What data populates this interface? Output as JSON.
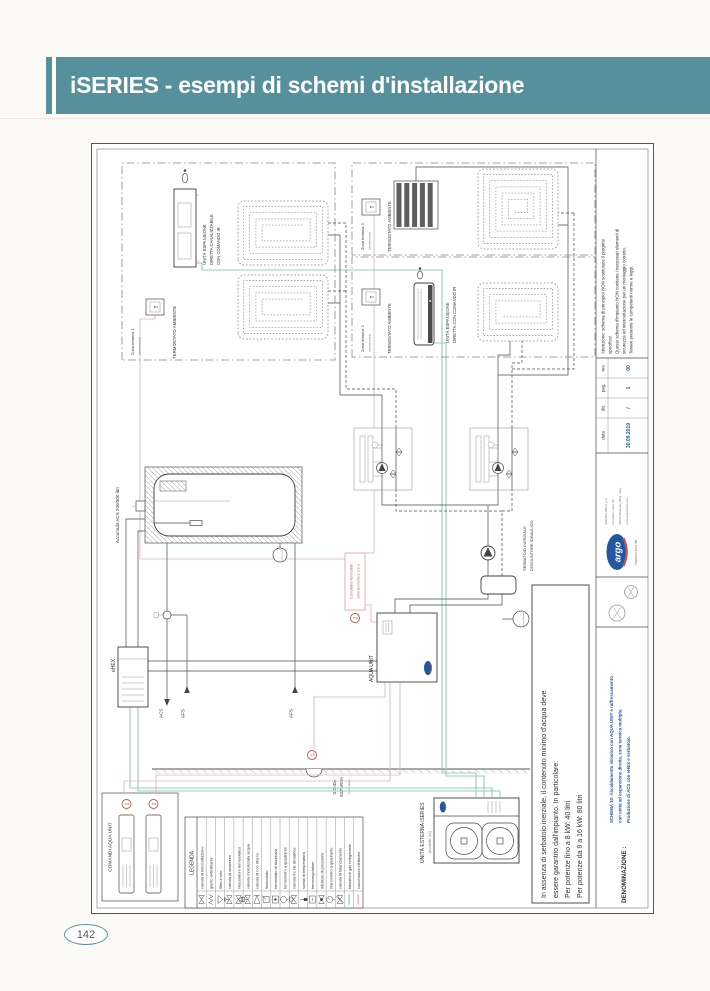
{
  "page": {
    "title": "iSERIES - esempi di schemi d'installazione",
    "number": "142"
  },
  "colors": {
    "header_teal": "#57909d",
    "accent_red": "#c4554e",
    "accent_blue": "#2456a4",
    "refrigerant_green": "#97cdb4",
    "electrical_pink": "#dfb3bb"
  },
  "diagram": {
    "zones": {
      "zone1": {
        "name": "Zona termica 1",
        "sub": "(temperatura)",
        "t": "T",
        "thermostat_label": "TERMOSTATO AMBIENTE",
        "unit_lines": [
          "UNITÀ ESPANSIONE",
          "DIRETTA CANALIZZABILE",
          "CON COMANDO IR"
        ]
      },
      "zone2": {
        "name": "Zona termica 2",
        "sub": "(temperatura)",
        "t": "T",
        "thermostat_label": "TERMOSTATO AMBIENTE",
        "unit_lines": [
          "UNITÀ ESPANSIONE",
          "DIRETTA CON COMANDO IR"
        ]
      },
      "zone3": {
        "name": "Zona termica 3",
        "sub": "(temperatura)",
        "t": "T",
        "thermostat_label": "TERMOSTATO AMBIENTE"
      }
    },
    "labels": {
      "tank": "Accumulo ACS 200/300 litri",
      "ehex": "eHEX",
      "acs": "ACS",
      "afs_top": "AFS",
      "afs_bottom": "AFS",
      "aqua_unit": "AQUA UNIT",
      "separator_lines": [
        "SERBATOIO INERZIALE",
        "DISGIUNTORE IDRAULICO"
      ],
      "sonda_lines": [
        "SONDA",
        "ESTERNA",
        "(opzionale)"
      ],
      "outdoor_unit": "UNITÀ ESTERNA iSERIES",
      "outdoor_model": "(modello XX)",
      "comandi": "COMANDI AQUA UNIT",
      "cumulativo_lines": [
        "Cumulativo termostati",
        "zone termiche 1 2 e 3"
      ],
      "marker1": "1",
      "marker2": "2"
    },
    "note_lines": [
      "In assenza di serbatoio inerziale, il contenuto minimo d'acqua deve",
      "essere garantito dall'impianto. In particolare:",
      "Per potenze fino a 8 kW: 40 litri",
      "Per potenze da 9 a 16 kW: 80 litri"
    ],
    "legend": {
      "title": "LEGENDA",
      "items": [
        {
          "label": "valvola di intercettazione",
          "symbol": "gate-valve"
        },
        {
          "label": "giunto antivibrante",
          "symbol": "flex-joint"
        },
        {
          "label": "filtro a rete",
          "symbol": "strainer"
        },
        {
          "label": "valvola di sicurezza",
          "symbol": "safety-valve"
        },
        {
          "label": "miscelatore termostatico",
          "symbol": "mixing-valve"
        },
        {
          "label": "valvola motorizzata acqua",
          "symbol": "motor-valve"
        },
        {
          "label": "valvola di non ritorno",
          "symbol": "check-valve"
        },
        {
          "label": "flussostato",
          "symbol": "flow-switch"
        },
        {
          "label": "termostato di sicurezza",
          "symbol": "safety-thermostat"
        },
        {
          "label": "termometro a quadrante",
          "symbol": "thermometer"
        },
        {
          "label": "valvola tre vie deviatrice",
          "symbol": "three-way-valve"
        },
        {
          "label": "sonda di temperatura",
          "symbol": "temp-probe"
        },
        {
          "label": "termoregolatore",
          "symbol": "controller"
        },
        {
          "label": "riduttore di pressione",
          "symbol": "pressure-reducer"
        },
        {
          "label": "manometro a quadrante",
          "symbol": "manometer"
        },
        {
          "label": "valvola di bilanciamento",
          "symbol": "balancing-valve"
        },
        {
          "label": "tubazione gas refrigerante",
          "symbol": "refrigerant-line"
        },
        {
          "label": "connessioni elettriche",
          "symbol": "electric-line"
        }
      ]
    },
    "titleblock": {
      "attenzione_lines": [
        "Attenzione: schema di principio! NON sostituisce il progetto",
        "specifico!",
        "Questo schema d'impianto NON contiene i necessari elementi di",
        "sicurezza ed intercettazione per un montaggio corretto.",
        "Tenere presente le competenti norme e leggi."
      ],
      "fields": [
        {
          "label": "data",
          "value": "30.09.2019"
        },
        {
          "label": "dis.",
          "value": "/"
        },
        {
          "label": "pag.",
          "value": "1"
        },
        {
          "label": "rev.",
          "value": "00"
        }
      ],
      "denominazione_label": "DENOMINAZIONE :",
      "denominazione_lines": [
        "SCHEMA 10: riscaldamento idronico con AQUA UNIT e raffrescamento",
        "con unità ad espansione diretta, zona termica multipla.",
        "Produzione di ACS con eHEX e serbatoio."
      ],
      "brand": {
        "name": "argo",
        "tagline": "improve your life",
        "company_lines": [
          "ARGOCLIMA S.p.A.",
          "Via Alfeno Varo 35",
          "25020 Alfianello (BS) - Italy",
          "www.argoclima.com"
        ]
      }
    }
  }
}
